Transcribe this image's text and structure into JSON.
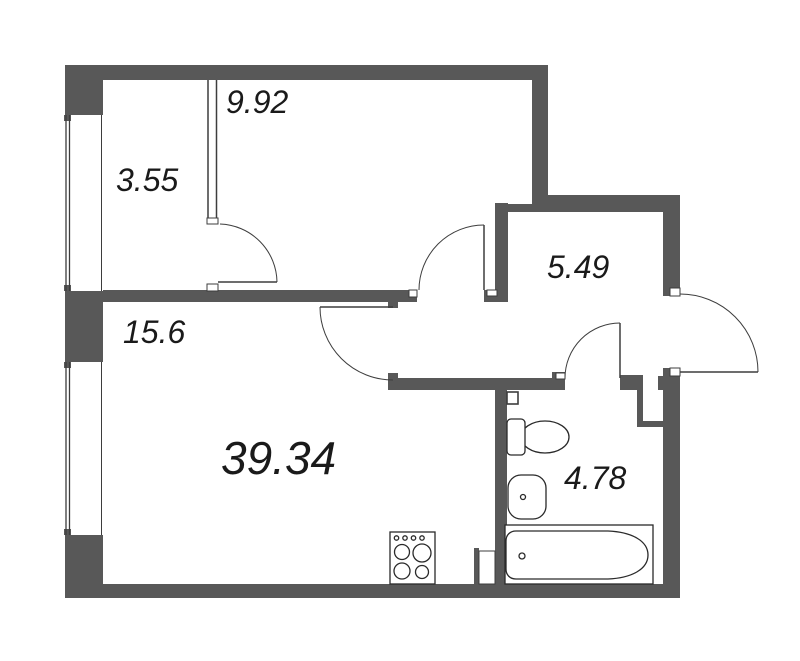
{
  "floorplan": {
    "total_area": "39.34",
    "rooms": [
      {
        "area": "9.92"
      },
      {
        "area": "3.55"
      },
      {
        "area": "15.6"
      },
      {
        "area": "5.49"
      },
      {
        "area": "4.78"
      }
    ],
    "fixtures": [
      "toilet",
      "sink",
      "bathtub",
      "stove"
    ],
    "colors": {
      "wall": "#585858",
      "line": "#3d3d3d",
      "fixture_line": "#2a2a2a",
      "text": "#1a1a1a",
      "background": "#ffffff"
    }
  }
}
